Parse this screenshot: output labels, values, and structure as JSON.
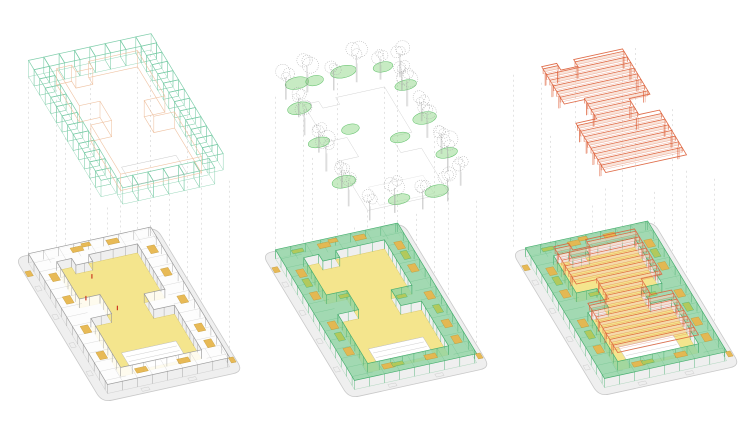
{
  "diagram": {
    "kind": "exploded-axonometric-architecture-diagram",
    "background": "#ffffff",
    "panels": [
      {
        "name": "modular-frame",
        "layer": "cube-grid",
        "ring": "gray",
        "roof_on_plan": false,
        "plan_origin": {
          "x": 15,
          "y": 258
        },
        "layer_origin": {
          "x": 15,
          "y": 72
        },
        "dash_zL": 0
      },
      {
        "name": "planting",
        "layer": "trees",
        "ring": "green",
        "roof_on_plan": false,
        "plan_origin": {
          "x": 262,
          "y": 254
        },
        "layer_origin": {
          "x": 262,
          "y": 92
        },
        "dash_zL": 0
      },
      {
        "name": "roof-structure",
        "layer": "truss-roof",
        "ring": "green",
        "roof_on_plan": true,
        "plan_origin": {
          "x": 512,
          "y": 252
        },
        "layer_origin": {
          "x": 500,
          "y": 80
        },
        "dash_zL": 10
      }
    ]
  },
  "projection": {
    "ux": 0.94,
    "uy": -0.206,
    "vx": 0.342,
    "vy": 0.566
  },
  "colors": {
    "plate_fill": "#efefef",
    "plate_edge": "#c9c9c9",
    "courtyard_fill": "#f4e58d",
    "courtyard_edge": "#dcc96a",
    "cube": "#79cba6",
    "orange_soft": "#eec09e",
    "canopy": "#8fd3a2",
    "canopy_edge": "#46ae6e",
    "gray_ring": "#9b9b9b",
    "slab_white": "#ffffff",
    "amber": "#e7b74e",
    "amber_edge": "#bf9430",
    "olive": "#b3c958",
    "orange": "#dd5f38",
    "orange_fill": "#f6d2c0",
    "tree": "#a5a5a5",
    "blob": "#90d788",
    "blob_edge": "#5cbf66",
    "figure": "#cc3a21",
    "dash": "#c4c4c4",
    "stage_line": "#bdbdbd"
  },
  "geometry": {
    "plate": [
      150,
      255
    ],
    "plate_corner_radius": 10,
    "ring": [
      10,
      12,
      140,
      243
    ],
    "ringH": 9,
    "bay_step": 16,
    "courtyard": [
      [
        118,
        34
      ],
      [
        66,
        34
      ],
      [
        66,
        46
      ],
      [
        48,
        46
      ],
      [
        48,
        34
      ],
      [
        32,
        34
      ],
      [
        32,
        100
      ],
      [
        54,
        100
      ],
      [
        54,
        134
      ],
      [
        32,
        134
      ],
      [
        32,
        221
      ],
      [
        118,
        221
      ],
      [
        118,
        142
      ],
      [
        96,
        142
      ],
      [
        96,
        114
      ],
      [
        118,
        114
      ]
    ],
    "stage": [
      46,
      185,
      104,
      217
    ],
    "edge_marks": [
      [
        2,
        52,
        5,
        8
      ],
      [
        2,
        102,
        5,
        8
      ],
      [
        2,
        152,
        5,
        8
      ],
      [
        2,
        202,
        5,
        8
      ],
      [
        44,
        247,
        8,
        5
      ],
      [
        94,
        247,
        8,
        5
      ],
      [
        70,
        2,
        8,
        5
      ]
    ],
    "pads": [
      [
        58,
        22,
        12,
        8
      ],
      [
        96,
        22,
        12,
        8
      ],
      [
        21,
        58,
        8,
        13
      ],
      [
        21,
        98,
        8,
        13
      ],
      [
        21,
        150,
        8,
        13
      ],
      [
        21,
        196,
        8,
        13
      ],
      [
        50,
        232,
        12,
        8
      ],
      [
        95,
        232,
        12,
        8
      ],
      [
        129,
        48,
        8,
        13
      ],
      [
        129,
        88,
        8,
        13
      ],
      [
        129,
        136,
        8,
        13
      ],
      [
        129,
        186,
        8,
        13
      ],
      [
        129,
        214,
        8,
        13
      ]
    ],
    "olive_strips": [
      [
        21,
        75,
        7,
        14
      ],
      [
        21,
        170,
        7,
        14
      ],
      [
        129,
        65,
        7,
        14
      ],
      [
        129,
        160,
        7,
        14
      ],
      [
        60,
        232,
        12,
        6
      ],
      [
        48,
        108,
        10,
        6
      ],
      [
        102,
        128,
        10,
        6
      ],
      [
        30,
        22,
        12,
        6
      ]
    ],
    "ground_pads": [
      [
        4,
        30,
        6,
        9
      ],
      [
        74,
        4,
        9,
        6
      ],
      [
        146,
        234,
        5,
        9
      ]
    ],
    "figures": [
      [
        60,
        60
      ],
      [
        66,
        118
      ],
      [
        42,
        92
      ]
    ],
    "cube": 16.3,
    "cube_runs": [
      {
        "x": 10,
        "y": 12,
        "dx": 1,
        "dy": 0,
        "n": 8
      },
      {
        "x": 26.3,
        "y": 226.7,
        "dx": 1,
        "dy": 0,
        "n": 6
      },
      {
        "x": 10,
        "y": 28.3,
        "dx": 0,
        "dy": 1,
        "n": 12
      },
      {
        "x": 123.7,
        "y": 28.3,
        "dx": 0,
        "dy": 1,
        "n": 12
      }
    ],
    "trees": [
      [
        18,
        20,
        22,
        7
      ],
      [
        42,
        16,
        26,
        8
      ],
      [
        68,
        22,
        20,
        6
      ],
      [
        94,
        17,
        27,
        8
      ],
      [
        118,
        21,
        21,
        6
      ],
      [
        138,
        24,
        24,
        7
      ],
      [
        132,
        46,
        20,
        6
      ],
      [
        128,
        72,
        26,
        8
      ],
      [
        133,
        100,
        19,
        6
      ],
      [
        129,
        128,
        24,
        7
      ],
      [
        133,
        158,
        20,
        6
      ],
      [
        129,
        188,
        26,
        8
      ],
      [
        133,
        214,
        20,
        6
      ],
      [
        112,
        234,
        23,
        7
      ],
      [
        84,
        238,
        19,
        6
      ],
      [
        56,
        234,
        25,
        8
      ],
      [
        28,
        237,
        20,
        6
      ],
      [
        16,
        208,
        24,
        7
      ],
      [
        20,
        178,
        19,
        6
      ],
      [
        15,
        146,
        26,
        8
      ],
      [
        19,
        114,
        20,
        6
      ],
      [
        15,
        82,
        25,
        7
      ],
      [
        20,
        52,
        19,
        6
      ]
    ],
    "blobs": [
      [
        30,
        20,
        12,
        6
      ],
      [
        80,
        18,
        13,
        6
      ],
      [
        120,
        24,
        10,
        5
      ],
      [
        131,
        60,
        11,
        5
      ],
      [
        130,
        118,
        12,
        6
      ],
      [
        131,
        180,
        11,
        5
      ],
      [
        100,
        236,
        12,
        6
      ],
      [
        60,
        236,
        11,
        5
      ],
      [
        18,
        190,
        12,
        6
      ],
      [
        17,
        120,
        11,
        5
      ],
      [
        18,
        60,
        12,
        6
      ],
      [
        48,
        22,
        9,
        5
      ],
      [
        96,
        140,
        10,
        5
      ],
      [
        54,
        110,
        9,
        5
      ]
    ],
    "blobZ": 14,
    "roof": {
      "y0": 38,
      "y1": 214,
      "step": 10,
      "depth": 5,
      "x0": 32,
      "x1": 118,
      "north_notch": {
        "until": 46,
        "gap": [
          48,
          66
        ]
      },
      "west_step": {
        "from": 100,
        "to": 134,
        "x": 54
      },
      "east_step": {
        "from": 114,
        "to": 142,
        "x": 96
      },
      "layer_ztop": 26,
      "layer_post_to": 10,
      "plan_ztop": 18,
      "plan_post_to": 4
    },
    "dash_pts": [
      [
        10,
        12
      ],
      [
        76,
        12
      ],
      [
        140,
        12
      ],
      [
        140,
        120
      ],
      [
        140,
        243
      ],
      [
        76,
        243
      ],
      [
        10,
        243
      ],
      [
        10,
        120
      ],
      [
        32,
        34
      ],
      [
        118,
        34
      ],
      [
        118,
        221
      ],
      [
        32,
        221
      ]
    ]
  }
}
